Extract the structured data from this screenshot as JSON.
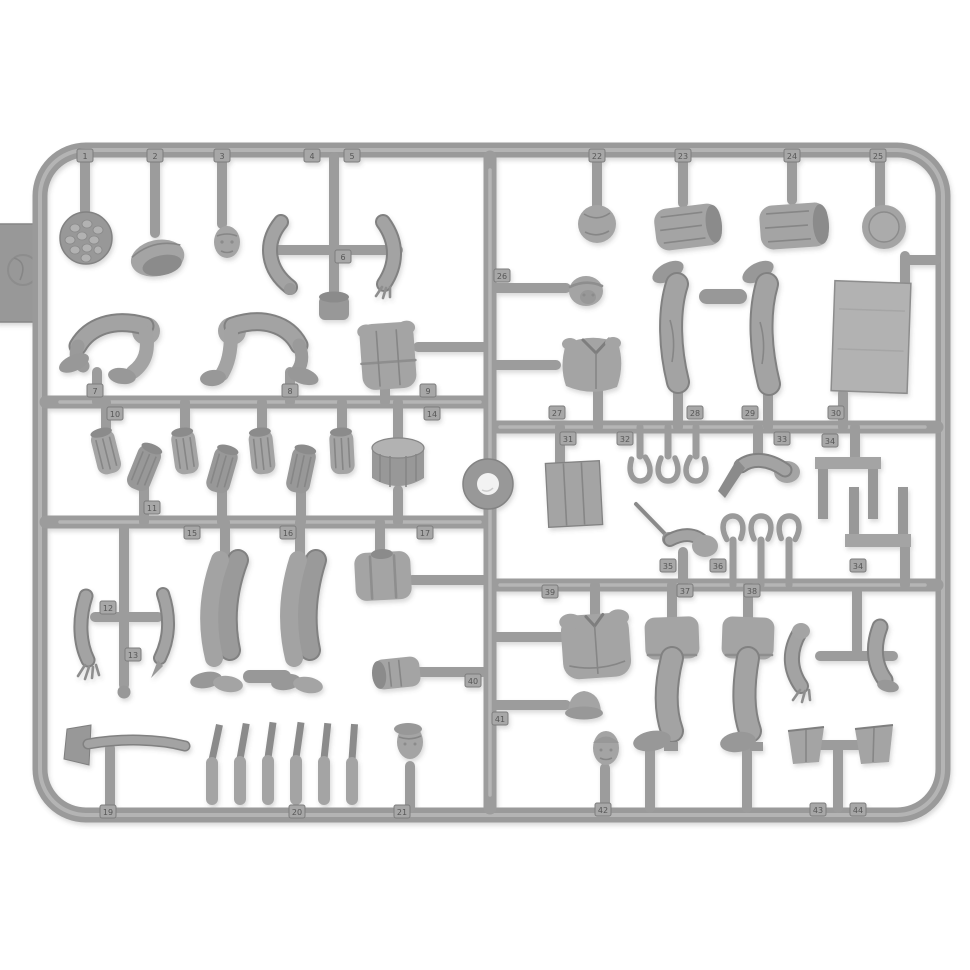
{
  "meta": {
    "subject": "injection-molded-plastic-model-figure-sprue-photo",
    "background_color": "#ffffff",
    "plastic_color": "#a4a4a4",
    "plastic_dark": "#8b8b8b",
    "plastic_light": "#bcbcbc",
    "tag_text_color": "#575757"
  },
  "sprue": {
    "part_tags": [
      {
        "n": "1",
        "x": 85,
        "y": 156
      },
      {
        "n": "2",
        "x": 155,
        "y": 156
      },
      {
        "n": "3",
        "x": 222,
        "y": 156
      },
      {
        "n": "4",
        "x": 312,
        "y": 156
      },
      {
        "n": "5",
        "x": 352,
        "y": 156
      },
      {
        "n": "22",
        "x": 597,
        "y": 156
      },
      {
        "n": "23",
        "x": 683,
        "y": 156
      },
      {
        "n": "24",
        "x": 792,
        "y": 156
      },
      {
        "n": "25",
        "x": 878,
        "y": 156
      },
      {
        "n": "6",
        "x": 343,
        "y": 257
      },
      {
        "n": "7",
        "x": 95,
        "y": 391
      },
      {
        "n": "8",
        "x": 290,
        "y": 391
      },
      {
        "n": "9",
        "x": 428,
        "y": 391
      },
      {
        "n": "10",
        "x": 115,
        "y": 414
      },
      {
        "n": "14",
        "x": 432,
        "y": 414
      },
      {
        "n": "26",
        "x": 502,
        "y": 276
      },
      {
        "n": "27",
        "x": 557,
        "y": 413
      },
      {
        "n": "28",
        "x": 695,
        "y": 413
      },
      {
        "n": "29",
        "x": 750,
        "y": 413
      },
      {
        "n": "30",
        "x": 836,
        "y": 413
      },
      {
        "n": "31",
        "x": 568,
        "y": 439
      },
      {
        "n": "32",
        "x": 625,
        "y": 439
      },
      {
        "n": "33",
        "x": 782,
        "y": 439
      },
      {
        "n": "34",
        "x": 830,
        "y": 441
      },
      {
        "n": "11",
        "x": 152,
        "y": 508
      },
      {
        "n": "15",
        "x": 192,
        "y": 533
      },
      {
        "n": "16",
        "x": 288,
        "y": 533
      },
      {
        "n": "17",
        "x": 425,
        "y": 533
      },
      {
        "n": "12",
        "x": 108,
        "y": 608
      },
      {
        "n": "13",
        "x": 133,
        "y": 655
      },
      {
        "n": "35",
        "x": 668,
        "y": 566
      },
      {
        "n": "36",
        "x": 718,
        "y": 566
      },
      {
        "n": "34",
        "x": 858,
        "y": 566
      },
      {
        "n": "39",
        "x": 550,
        "y": 592
      },
      {
        "n": "37",
        "x": 685,
        "y": 591
      },
      {
        "n": "38",
        "x": 752,
        "y": 591
      },
      {
        "n": "40",
        "x": 473,
        "y": 681
      },
      {
        "n": "41",
        "x": 500,
        "y": 719
      },
      {
        "n": "19",
        "x": 108,
        "y": 812
      },
      {
        "n": "20",
        "x": 297,
        "y": 812
      },
      {
        "n": "21",
        "x": 402,
        "y": 812
      },
      {
        "n": "42",
        "x": 603,
        "y": 810
      },
      {
        "n": "43",
        "x": 818,
        "y": 810
      },
      {
        "n": "44",
        "x": 858,
        "y": 810
      }
    ],
    "parts_inventory": [
      {
        "number": "1",
        "name": "mess-plate-with-food"
      },
      {
        "number": "2",
        "name": "overturned-field-cap"
      },
      {
        "number": "3",
        "name": "bare-head"
      },
      {
        "number": "4",
        "name": "left-arm"
      },
      {
        "number": "5",
        "name": "right-arm-open-hand"
      },
      {
        "number": "6",
        "name": "mug"
      },
      {
        "number": "7",
        "name": "seated-legs-pair"
      },
      {
        "number": "8",
        "name": "seated-legs-pair"
      },
      {
        "number": "9",
        "name": "torso-back"
      },
      {
        "number": "10",
        "name": "firewood-log-set"
      },
      {
        "number": "11",
        "name": "firewood-log-set"
      },
      {
        "number": "12",
        "name": "arm-with-open-hand"
      },
      {
        "number": "13",
        "name": "arm"
      },
      {
        "number": "14",
        "name": "wood-stump"
      },
      {
        "number": "15",
        "name": "standing-legs-pair"
      },
      {
        "number": "16",
        "name": "standing-legs-pair"
      },
      {
        "number": "17",
        "name": "torso-with-suspenders"
      },
      {
        "number": "19",
        "name": "axe"
      },
      {
        "number": "20",
        "name": "knife-set"
      },
      {
        "number": "21",
        "name": "head-with-peaked-cap"
      },
      {
        "number": "22",
        "name": "bread-loaf"
      },
      {
        "number": "23",
        "name": "log-roll"
      },
      {
        "number": "24",
        "name": "log-roll"
      },
      {
        "number": "25",
        "name": "round-plate"
      },
      {
        "number": "26",
        "name": "head-with-cap"
      },
      {
        "number": "27",
        "name": "tunic-torso"
      },
      {
        "number": "28",
        "name": "inverted-leg-with-boot"
      },
      {
        "number": "29",
        "name": "inverted-leg-with-boot"
      },
      {
        "number": "30",
        "name": "blanket-panel"
      },
      {
        "number": "31",
        "name": "wooden-crate"
      },
      {
        "number": "32",
        "name": "horseshoe-trio"
      },
      {
        "number": "33",
        "name": "arm-holding-knife"
      },
      {
        "number": "34",
        "name": "bench-stool"
      },
      {
        "number": "35",
        "name": "arm-holding-stick"
      },
      {
        "number": "36",
        "name": "horseshoe-trio"
      },
      {
        "number": "37",
        "name": "booted-leg"
      },
      {
        "number": "38",
        "name": "booted-leg"
      },
      {
        "number": "39",
        "name": "jacket-torso"
      },
      {
        "number": "40",
        "name": "side-lying-pot"
      },
      {
        "number": "41",
        "name": "hat"
      },
      {
        "number": "42",
        "name": "head-with-helmet"
      },
      {
        "number": "43",
        "name": "bucket"
      },
      {
        "number": "44",
        "name": "bucket"
      }
    ]
  }
}
